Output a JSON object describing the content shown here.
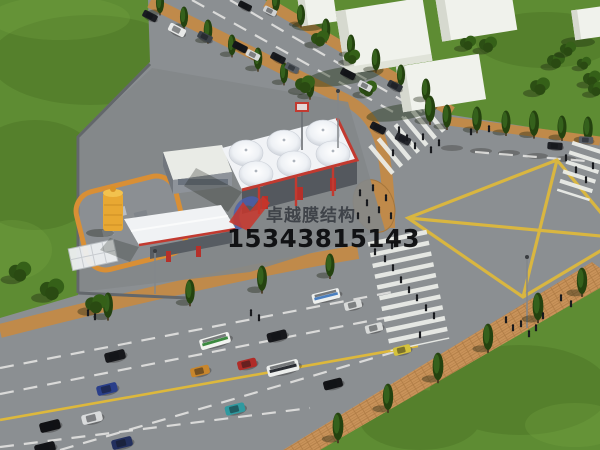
{
  "watermark": {
    "brand_text": "卓越膜结构",
    "phone_number": "15343815143",
    "logo_red": "#c8362c",
    "logo_blue": "#4a5fae"
  },
  "palette": {
    "grass": "#5e8c33",
    "road": "#8b8f92",
    "sidewalk": "#c08a4a",
    "sidewalk_brick": "#c9935a",
    "lane_yellow": "#ddb83c",
    "lane_white": "#e7e8e5",
    "canopy_white": "#f1f3f6",
    "trim_red": "#c23a30",
    "tank_yellow": "#e8a832",
    "containment_orange": "#d98f35",
    "building_white": "#f0f2ec",
    "building_side": "#d6d9cf"
  },
  "scene": {
    "cars": [
      {
        "x": 150,
        "y": 16,
        "r": 27,
        "s": 0.95,
        "c": "#1b1d22"
      },
      {
        "x": 177,
        "y": 30,
        "r": 27,
        "s": 1.1,
        "c": "#e8e9e8"
      },
      {
        "x": 205,
        "y": 37,
        "r": 27,
        "s": 0.95,
        "c": "#3c4248"
      },
      {
        "x": 240,
        "y": 47,
        "r": 27,
        "s": 0.95,
        "c": "#14161a"
      },
      {
        "x": 253,
        "y": 55,
        "r": 27,
        "s": 0.9,
        "c": "#d7d9da"
      },
      {
        "x": 278,
        "y": 58,
        "r": 27,
        "s": 0.95,
        "c": "#1a1c20"
      },
      {
        "x": 292,
        "y": 68,
        "r": 27,
        "s": 0.9,
        "c": "#575d64"
      },
      {
        "x": 348,
        "y": 74,
        "r": 27,
        "s": 0.95,
        "c": "#15171b"
      },
      {
        "x": 365,
        "y": 86,
        "r": 27,
        "s": 0.9,
        "c": "#d8dadb"
      },
      {
        "x": 395,
        "y": 86,
        "r": 27,
        "s": 0.95,
        "c": "#2c3137"
      },
      {
        "x": 378,
        "y": 128,
        "r": 27,
        "s": 1.0,
        "c": "#191b1f"
      },
      {
        "x": 403,
        "y": 139,
        "r": 27,
        "s": 1.0,
        "c": "#24262c"
      },
      {
        "x": 245,
        "y": 6,
        "r": 27,
        "s": 0.85,
        "c": "#15171a"
      },
      {
        "x": 270,
        "y": 11,
        "r": 27,
        "s": 0.85,
        "c": "#cfd1d2"
      },
      {
        "x": 555,
        "y": 146,
        "r": 4,
        "s": 0.95,
        "c": "#1d1f24"
      },
      {
        "x": 586,
        "y": 140,
        "r": 4,
        "s": 0.9,
        "c": "#585e66"
      },
      {
        "x": 115,
        "y": 356,
        "r": -14,
        "s": 1.3,
        "c": "#17181c"
      },
      {
        "x": 107,
        "y": 389,
        "r": -14,
        "s": 1.3,
        "c": "#2a3f8a"
      },
      {
        "x": 92,
        "y": 418,
        "r": -14,
        "s": 1.3,
        "c": "#d9dbdc"
      },
      {
        "x": 50,
        "y": 426,
        "r": -14,
        "s": 1.3,
        "c": "#101114"
      },
      {
        "x": 122,
        "y": 443,
        "r": -14,
        "s": 1.3,
        "c": "#23305e"
      },
      {
        "x": 200,
        "y": 371,
        "r": -14,
        "s": 1.2,
        "c": "#c8862c"
      },
      {
        "x": 247,
        "y": 364,
        "r": -14,
        "s": 1.2,
        "c": "#b02c28"
      },
      {
        "x": 277,
        "y": 336,
        "r": -14,
        "s": 1.25,
        "c": "#17181c"
      },
      {
        "x": 235,
        "y": 409,
        "r": -14,
        "s": 1.25,
        "c": "#2f9aa0"
      },
      {
        "x": 45,
        "y": 448,
        "r": -14,
        "s": 1.3,
        "c": "#131418"
      },
      {
        "x": 333,
        "y": 384,
        "r": -14,
        "s": 1.2,
        "c": "#131417"
      },
      {
        "x": 353,
        "y": 305,
        "r": -14,
        "s": 1.1,
        "c": "#d8dad9"
      },
      {
        "x": 374,
        "y": 328,
        "r": -14,
        "s": 1.1,
        "c": "#d8dad9"
      },
      {
        "x": 402,
        "y": 350,
        "r": -14,
        "s": 1.1,
        "c": "#d4c23c"
      }
    ],
    "buses": [
      {
        "x": 215,
        "y": 341,
        "r": -16,
        "s": 1.1,
        "c": "#f2f4f0",
        "c2": "#3c8a40"
      },
      {
        "x": 283,
        "y": 368,
        "r": -14,
        "s": 1.15,
        "c": "#eceeec",
        "c2": "#2a2d33"
      },
      {
        "x": 326,
        "y": 296,
        "r": -14,
        "s": 1.0,
        "c": "#eef0ee",
        "c2": "#4a7fc0"
      }
    ],
    "trees_columnar": [
      {
        "x": 160,
        "y": 10,
        "s": 0.9
      },
      {
        "x": 184,
        "y": 24,
        "s": 0.9
      },
      {
        "x": 208,
        "y": 38,
        "s": 0.95
      },
      {
        "x": 232,
        "y": 52,
        "s": 0.9
      },
      {
        "x": 258,
        "y": 66,
        "s": 0.95
      },
      {
        "x": 284,
        "y": 80,
        "s": 0.9
      },
      {
        "x": 310,
        "y": 94,
        "s": 0.95
      },
      {
        "x": 276,
        "y": 8,
        "s": 0.9
      },
      {
        "x": 301,
        "y": 22,
        "s": 0.9
      },
      {
        "x": 326,
        "y": 37,
        "s": 0.95
      },
      {
        "x": 351,
        "y": 52,
        "s": 0.9
      },
      {
        "x": 376,
        "y": 67,
        "s": 0.95
      },
      {
        "x": 401,
        "y": 82,
        "s": 0.9
      },
      {
        "x": 426,
        "y": 97,
        "s": 0.95
      },
      {
        "x": 430,
        "y": 118,
        "s": 1.15
      },
      {
        "x": 447,
        "y": 124,
        "s": 1.0
      },
      {
        "x": 477,
        "y": 127,
        "s": 1.05
      },
      {
        "x": 506,
        "y": 130,
        "s": 1.0
      },
      {
        "x": 534,
        "y": 132,
        "s": 1.1
      },
      {
        "x": 562,
        "y": 135,
        "s": 1.0
      },
      {
        "x": 588,
        "y": 137,
        "s": 1.05
      },
      {
        "x": 338,
        "y": 436,
        "s": 1.2
      },
      {
        "x": 388,
        "y": 406,
        "s": 1.15
      },
      {
        "x": 438,
        "y": 376,
        "s": 1.2
      },
      {
        "x": 488,
        "y": 346,
        "s": 1.15
      },
      {
        "x": 538,
        "y": 316,
        "s": 1.2
      },
      {
        "x": 582,
        "y": 290,
        "s": 1.15
      },
      {
        "x": 108,
        "y": 314,
        "s": 1.1
      },
      {
        "x": 190,
        "y": 300,
        "s": 1.05
      },
      {
        "x": 262,
        "y": 287,
        "s": 1.1
      },
      {
        "x": 330,
        "y": 273,
        "s": 1.0
      }
    ],
    "trees_round": [
      {
        "x": 320,
        "y": 42,
        "s": 1.0
      },
      {
        "x": 305,
        "y": 88,
        "s": 1.1
      },
      {
        "x": 368,
        "y": 92,
        "s": 1.0
      },
      {
        "x": 352,
        "y": 60,
        "s": 0.9
      },
      {
        "x": 488,
        "y": 48,
        "s": 1.0
      },
      {
        "x": 468,
        "y": 46,
        "s": 0.9
      },
      {
        "x": 556,
        "y": 64,
        "s": 1.0
      },
      {
        "x": 592,
        "y": 82,
        "s": 1.0
      },
      {
        "x": 540,
        "y": 90,
        "s": 1.1
      },
      {
        "x": 568,
        "y": 52,
        "s": 0.9
      },
      {
        "x": 596,
        "y": 92,
        "s": 0.9
      },
      {
        "x": 584,
        "y": 66,
        "s": 0.8
      },
      {
        "x": 20,
        "y": 276,
        "s": 1.25
      },
      {
        "x": 52,
        "y": 294,
        "s": 1.35
      },
      {
        "x": 96,
        "y": 308,
        "s": 1.2
      }
    ],
    "pedestrians": [
      {
        "x": 360,
        "y": 196
      },
      {
        "x": 367,
        "y": 206
      },
      {
        "x": 373,
        "y": 191
      },
      {
        "x": 379,
        "y": 213
      },
      {
        "x": 386,
        "y": 201
      },
      {
        "x": 358,
        "y": 219
      },
      {
        "x": 391,
        "y": 219
      },
      {
        "x": 369,
        "y": 223
      },
      {
        "x": 375,
        "y": 255
      },
      {
        "x": 385,
        "y": 262
      },
      {
        "x": 393,
        "y": 271
      },
      {
        "x": 401,
        "y": 283
      },
      {
        "x": 409,
        "y": 293
      },
      {
        "x": 417,
        "y": 301
      },
      {
        "x": 392,
        "y": 249
      },
      {
        "x": 426,
        "y": 311
      },
      {
        "x": 434,
        "y": 319
      },
      {
        "x": 420,
        "y": 338
      },
      {
        "x": 399,
        "y": 133
      },
      {
        "x": 407,
        "y": 141
      },
      {
        "x": 415,
        "y": 149
      },
      {
        "x": 423,
        "y": 140
      },
      {
        "x": 431,
        "y": 153
      },
      {
        "x": 393,
        "y": 156
      },
      {
        "x": 439,
        "y": 146
      },
      {
        "x": 566,
        "y": 161
      },
      {
        "x": 576,
        "y": 173
      },
      {
        "x": 586,
        "y": 183
      },
      {
        "x": 593,
        "y": 169
      },
      {
        "x": 506,
        "y": 323
      },
      {
        "x": 513,
        "y": 331
      },
      {
        "x": 521,
        "y": 327
      },
      {
        "x": 529,
        "y": 337
      },
      {
        "x": 536,
        "y": 331
      },
      {
        "x": 543,
        "y": 319
      },
      {
        "x": 561,
        "y": 301
      },
      {
        "x": 571,
        "y": 307
      },
      {
        "x": 471,
        "y": 135
      },
      {
        "x": 489,
        "y": 132
      },
      {
        "x": 251,
        "y": 316
      },
      {
        "x": 259,
        "y": 321
      },
      {
        "x": 88,
        "y": 316
      },
      {
        "x": 95,
        "y": 320
      }
    ]
  }
}
